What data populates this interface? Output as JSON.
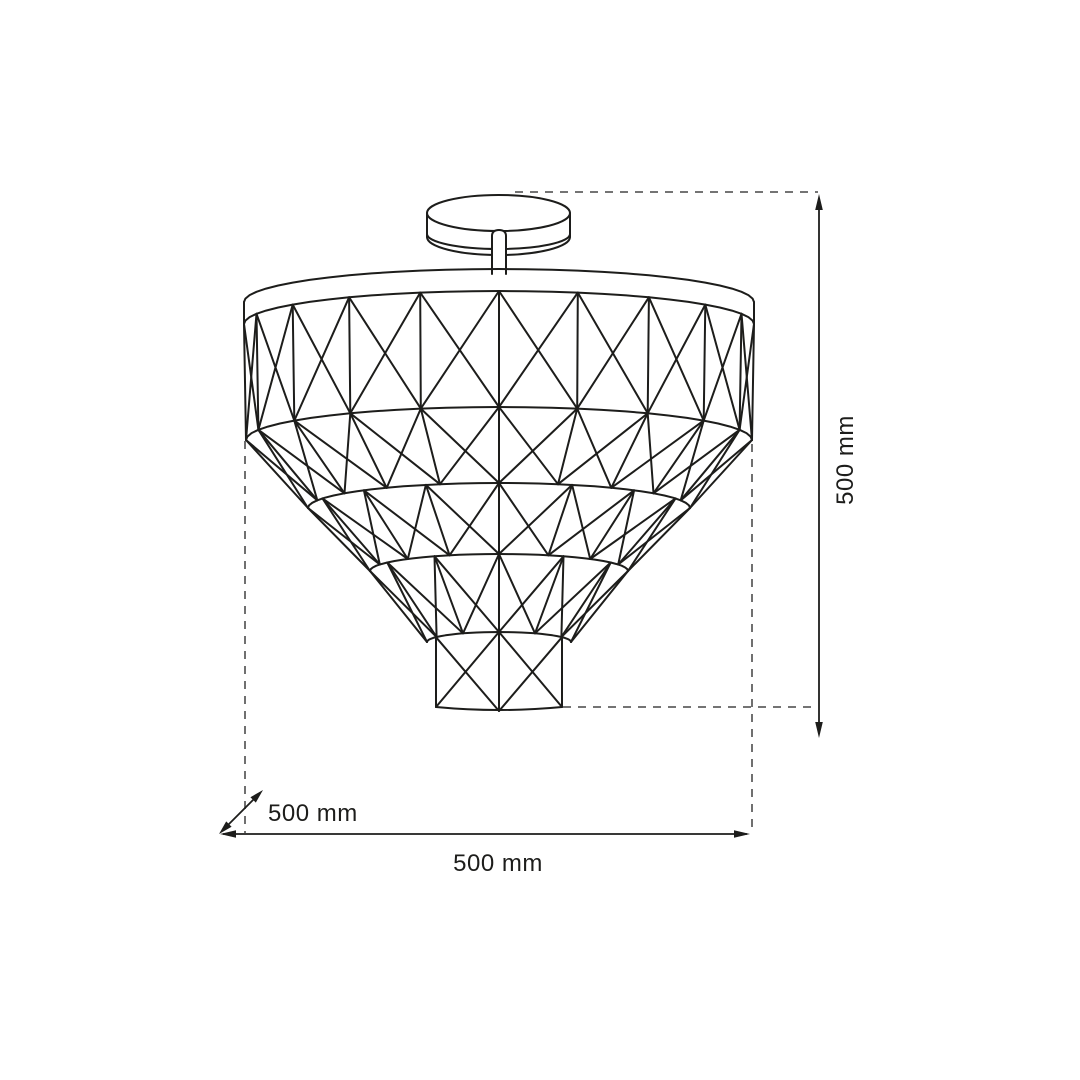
{
  "page": {
    "background": "#ffffff"
  },
  "drawing": {
    "subject": "ceiling-lamp-technical-drawing",
    "line_color": "#1d1d1b",
    "guide_color": "#606060"
  },
  "dimensions": {
    "height": {
      "label": "500 mm"
    },
    "width": {
      "label": "500 mm"
    },
    "depth": {
      "label": "500 mm"
    }
  }
}
